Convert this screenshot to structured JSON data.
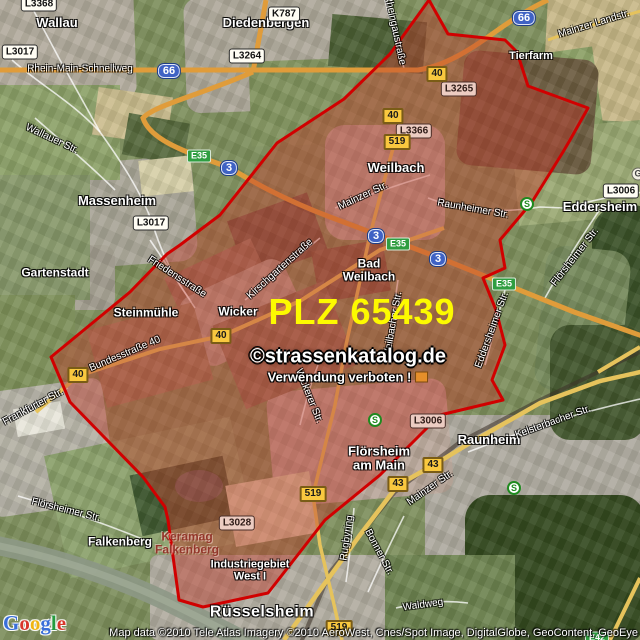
{
  "map": {
    "plz_label": "PLZ 65439",
    "watermark_line1": "©strassenkatalog.de",
    "watermark_line2": "Verwendung verboten !",
    "attribution": "Map data ©2010 Tele Atlas  Imagery ©2010 AeroWest, Cnes/Spot Image, DigitalGlobe, GeoContent, GeoEye",
    "logo_text": "Google",
    "logo_colors": [
      "#3a6fd8",
      "#d8362a",
      "#f0b512",
      "#3a6fd8",
      "#259b3e",
      "#d8362a"
    ],
    "colors": {
      "zone_fill": "#c23c2d",
      "zone_border": "#d10000",
      "plz_text": "#fdfa00",
      "highway_orange": "#e09c3a",
      "road_yellow": "#e6c35c"
    },
    "towns": [
      {
        "label": "Wallau",
        "x": 57,
        "y": 23,
        "size": "lg"
      },
      {
        "label": "Diedenbergen",
        "x": 266,
        "y": 23,
        "size": "lg"
      },
      {
        "label": "Tierfarm",
        "x": 531,
        "y": 57,
        "size": "sm"
      },
      {
        "label": "Massenheim",
        "x": 117,
        "y": 201,
        "size": "lg"
      },
      {
        "label": "Weilbach",
        "x": 396,
        "y": 168,
        "size": "lg"
      },
      {
        "label": "Bad\nWeilbach",
        "x": 369,
        "y": 270,
        "size": "md"
      },
      {
        "label": "Eddersheim",
        "x": 600,
        "y": 207,
        "size": "lg"
      },
      {
        "label": "Gartenstadt",
        "x": 55,
        "y": 273,
        "size": "md"
      },
      {
        "label": "Steinmühle",
        "x": 146,
        "y": 313,
        "size": "md"
      },
      {
        "label": "Wicker",
        "x": 238,
        "y": 312,
        "size": "md"
      },
      {
        "label": "Falkenberg",
        "x": 120,
        "y": 542,
        "size": "md"
      },
      {
        "label": "Keramag\nFalkenberg",
        "x": 187,
        "y": 543,
        "size": "md",
        "variant": "dark-red"
      },
      {
        "label": "Industriegebiet\nWest I",
        "x": 250,
        "y": 571,
        "size": "sm"
      },
      {
        "label": "Flörsheim\nam Main",
        "x": 379,
        "y": 458,
        "size": "lg"
      },
      {
        "label": "Raunheim",
        "x": 489,
        "y": 440,
        "size": "lg"
      },
      {
        "label": "Rüsselsheim",
        "x": 262,
        "y": 613,
        "size": "xl"
      }
    ],
    "streets": [
      {
        "label": "Rhein-Main-Schnellweg",
        "x": 80,
        "y": 69,
        "rot": 0
      },
      {
        "label": "Wallauer Str.",
        "x": 52,
        "y": 139,
        "rot": 25
      },
      {
        "label": "Rheingaustraße",
        "x": 395,
        "y": 30,
        "rot": 78
      },
      {
        "label": "Mainzer Landstr.",
        "x": 594,
        "y": 24,
        "rot": -17
      },
      {
        "label": "Mainzer Str.",
        "x": 363,
        "y": 196,
        "rot": -25
      },
      {
        "label": "Raunheimer Str.",
        "x": 473,
        "y": 209,
        "rot": 10
      },
      {
        "label": "Friedensstraße",
        "x": 177,
        "y": 277,
        "rot": 33
      },
      {
        "label": "Kirschgartenstraße",
        "x": 280,
        "y": 269,
        "rot": -42
      },
      {
        "label": "Bundesstraße 40",
        "x": 125,
        "y": 354,
        "rot": -23
      },
      {
        "label": "Frankfurter Str.",
        "x": 33,
        "y": 407,
        "rot": -28
      },
      {
        "label": "Weilbacher Str.",
        "x": 393,
        "y": 325,
        "rot": -80
      },
      {
        "label": "Wickerer Str.",
        "x": 309,
        "y": 396,
        "rot": 68
      },
      {
        "label": "Eddersheimer Str.",
        "x": 492,
        "y": 330,
        "rot": -70
      },
      {
        "label": "Flörsheimer Str.",
        "x": 575,
        "y": 257,
        "rot": -52
      },
      {
        "label": "Flörsheimer Str.",
        "x": 66,
        "y": 510,
        "rot": 14
      },
      {
        "label": "Kelsterbacher Str.",
        "x": 553,
        "y": 422,
        "rot": -20
      },
      {
        "label": "Mainzer Str.",
        "x": 430,
        "y": 488,
        "rot": -35
      },
      {
        "label": "Rugbyring",
        "x": 347,
        "y": 538,
        "rot": -82
      },
      {
        "label": "Bonner Str.",
        "x": 379,
        "y": 552,
        "rot": 62
      },
      {
        "label": "Waldweg",
        "x": 423,
        "y": 605,
        "rot": -8
      }
    ],
    "badges": [
      {
        "label": "L3368",
        "type": "white",
        "x": 39,
        "y": 4
      },
      {
        "label": "L3017",
        "type": "white",
        "x": 20,
        "y": 52
      },
      {
        "label": "K787",
        "type": "white",
        "x": 284,
        "y": 14
      },
      {
        "label": "L3264",
        "type": "white",
        "x": 247,
        "y": 56
      },
      {
        "label": "L3017",
        "type": "white",
        "x": 151,
        "y": 223
      },
      {
        "label": "L3265",
        "type": "white",
        "x": 459,
        "y": 89,
        "tint": true
      },
      {
        "label": "L3366",
        "type": "white",
        "x": 414,
        "y": 131,
        "tint": true
      },
      {
        "label": "L3006",
        "type": "white",
        "x": 621,
        "y": 191
      },
      {
        "label": "L3006",
        "type": "white",
        "x": 428,
        "y": 421,
        "tint": true
      },
      {
        "label": "L3028",
        "type": "white",
        "x": 237,
        "y": 523,
        "tint": true
      },
      {
        "label": "40",
        "type": "yellow",
        "x": 437,
        "y": 74
      },
      {
        "label": "40",
        "type": "yellow",
        "x": 393,
        "y": 116
      },
      {
        "label": "519",
        "type": "yellow",
        "x": 397,
        "y": 142
      },
      {
        "label": "40",
        "type": "yellow",
        "x": 221,
        "y": 336
      },
      {
        "label": "40",
        "type": "yellow",
        "x": 78,
        "y": 375
      },
      {
        "label": "519",
        "type": "yellow",
        "x": 313,
        "y": 494
      },
      {
        "label": "43",
        "type": "yellow",
        "x": 433,
        "y": 465
      },
      {
        "label": "43",
        "type": "yellow",
        "x": 398,
        "y": 484
      },
      {
        "label": "519",
        "type": "yellow",
        "x": 339,
        "y": 628
      },
      {
        "label": "66",
        "type": "blue",
        "x": 169,
        "y": 71
      },
      {
        "label": "66",
        "type": "blue",
        "x": 524,
        "y": 18
      },
      {
        "label": "3",
        "type": "blue",
        "x": 229,
        "y": 168
      },
      {
        "label": "3",
        "type": "blue",
        "x": 376,
        "y": 236
      },
      {
        "label": "3",
        "type": "blue",
        "x": 438,
        "y": 259
      },
      {
        "label": "E35",
        "type": "green",
        "x": 199,
        "y": 156
      },
      {
        "label": "E35",
        "type": "green",
        "x": 398,
        "y": 244
      },
      {
        "label": "E35",
        "type": "green",
        "x": 504,
        "y": 284
      },
      {
        "label": "E42",
        "type": "green",
        "x": 597,
        "y": 638
      }
    ],
    "transit": [
      {
        "label": "S",
        "x": 527,
        "y": 204
      },
      {
        "label": "S",
        "x": 375,
        "y": 420
      },
      {
        "label": "S",
        "x": 514,
        "y": 488
      }
    ],
    "poi": [
      {
        "label": "G",
        "x": 638,
        "y": 174
      }
    ]
  }
}
